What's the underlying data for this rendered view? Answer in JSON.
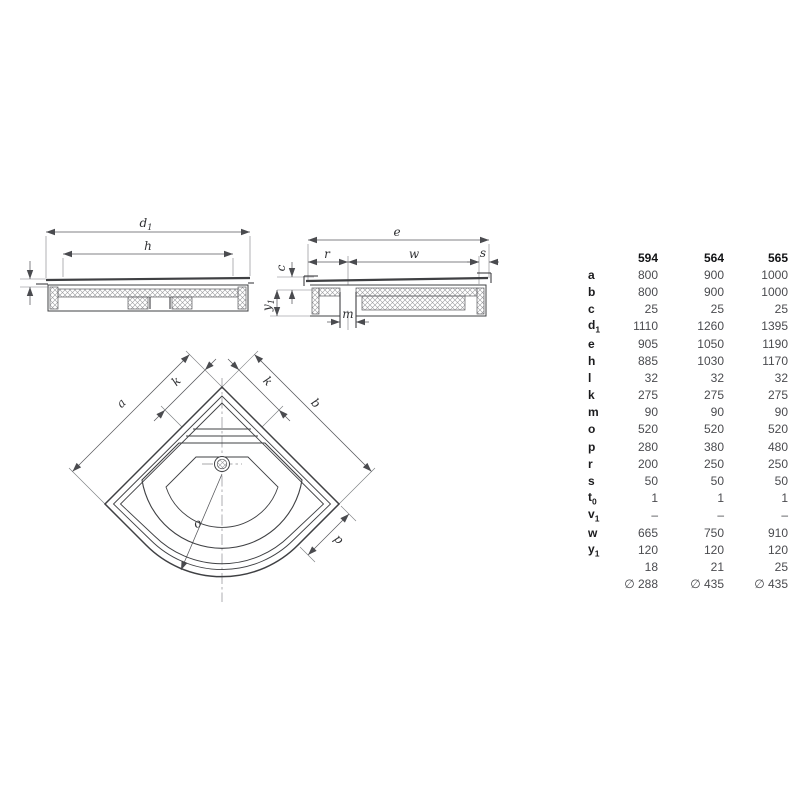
{
  "colors": {
    "background": "#ffffff",
    "drawing_line": "#3f4043",
    "dimension_line": "#56575b",
    "table_label": "#1b1b1d",
    "table_value": "#4a4b4f"
  },
  "drawings": {
    "front_view": {
      "d_label": "d",
      "d_sub": "1",
      "h": "h"
    },
    "side_view": {
      "e": "e",
      "r": "r",
      "w": "w",
      "s": "s",
      "c": "c",
      "y_label": "y",
      "y_sub": "1",
      "m": "m"
    },
    "plan_view": {
      "a": "a",
      "b": "b",
      "k_left": "k",
      "k_right": "k",
      "o": "o",
      "p": "p"
    }
  },
  "table": {
    "columns": [
      "594",
      "564",
      "565"
    ],
    "rows": [
      {
        "label": "a",
        "sub": "",
        "values": [
          "800",
          "900",
          "1000"
        ]
      },
      {
        "label": "b",
        "sub": "",
        "values": [
          "800",
          "900",
          "1000"
        ]
      },
      {
        "label": "c",
        "sub": "",
        "values": [
          "25",
          "25",
          "25"
        ]
      },
      {
        "label": "d",
        "sub": "1",
        "values": [
          "1110",
          "1260",
          "1395"
        ]
      },
      {
        "label": "e",
        "sub": "",
        "values": [
          "905",
          "1050",
          "1190"
        ]
      },
      {
        "label": "h",
        "sub": "",
        "values": [
          "885",
          "1030",
          "1170"
        ]
      },
      {
        "label": "l",
        "sub": "",
        "values": [
          "32",
          "32",
          "32"
        ]
      },
      {
        "label": "k",
        "sub": "",
        "values": [
          "275",
          "275",
          "275"
        ]
      },
      {
        "label": "m",
        "sub": "",
        "values": [
          "90",
          "90",
          "90"
        ]
      },
      {
        "label": "o",
        "sub": "",
        "values": [
          "520",
          "520",
          "520"
        ]
      },
      {
        "label": "p",
        "sub": "",
        "values": [
          "280",
          "380",
          "480"
        ]
      },
      {
        "label": "r",
        "sub": "",
        "values": [
          "200",
          "250",
          "250"
        ]
      },
      {
        "label": "s",
        "sub": "",
        "values": [
          "50",
          "50",
          "50"
        ]
      },
      {
        "label": "t",
        "sub": "0",
        "values": [
          "1",
          "1",
          "1"
        ]
      },
      {
        "label": "v",
        "sub": "1",
        "values": [
          "–",
          "–",
          "–"
        ]
      },
      {
        "label": "w",
        "sub": "",
        "values": [
          "665",
          "750",
          "910"
        ]
      },
      {
        "label": "y",
        "sub": "1",
        "values": [
          "120",
          "120",
          "120"
        ]
      },
      {
        "label": "",
        "sub": "",
        "values": [
          "18",
          "21",
          "25"
        ]
      },
      {
        "label": "",
        "sub": "",
        "values": [
          "∅ 288",
          "∅ 435",
          "∅ 435"
        ]
      }
    ]
  }
}
